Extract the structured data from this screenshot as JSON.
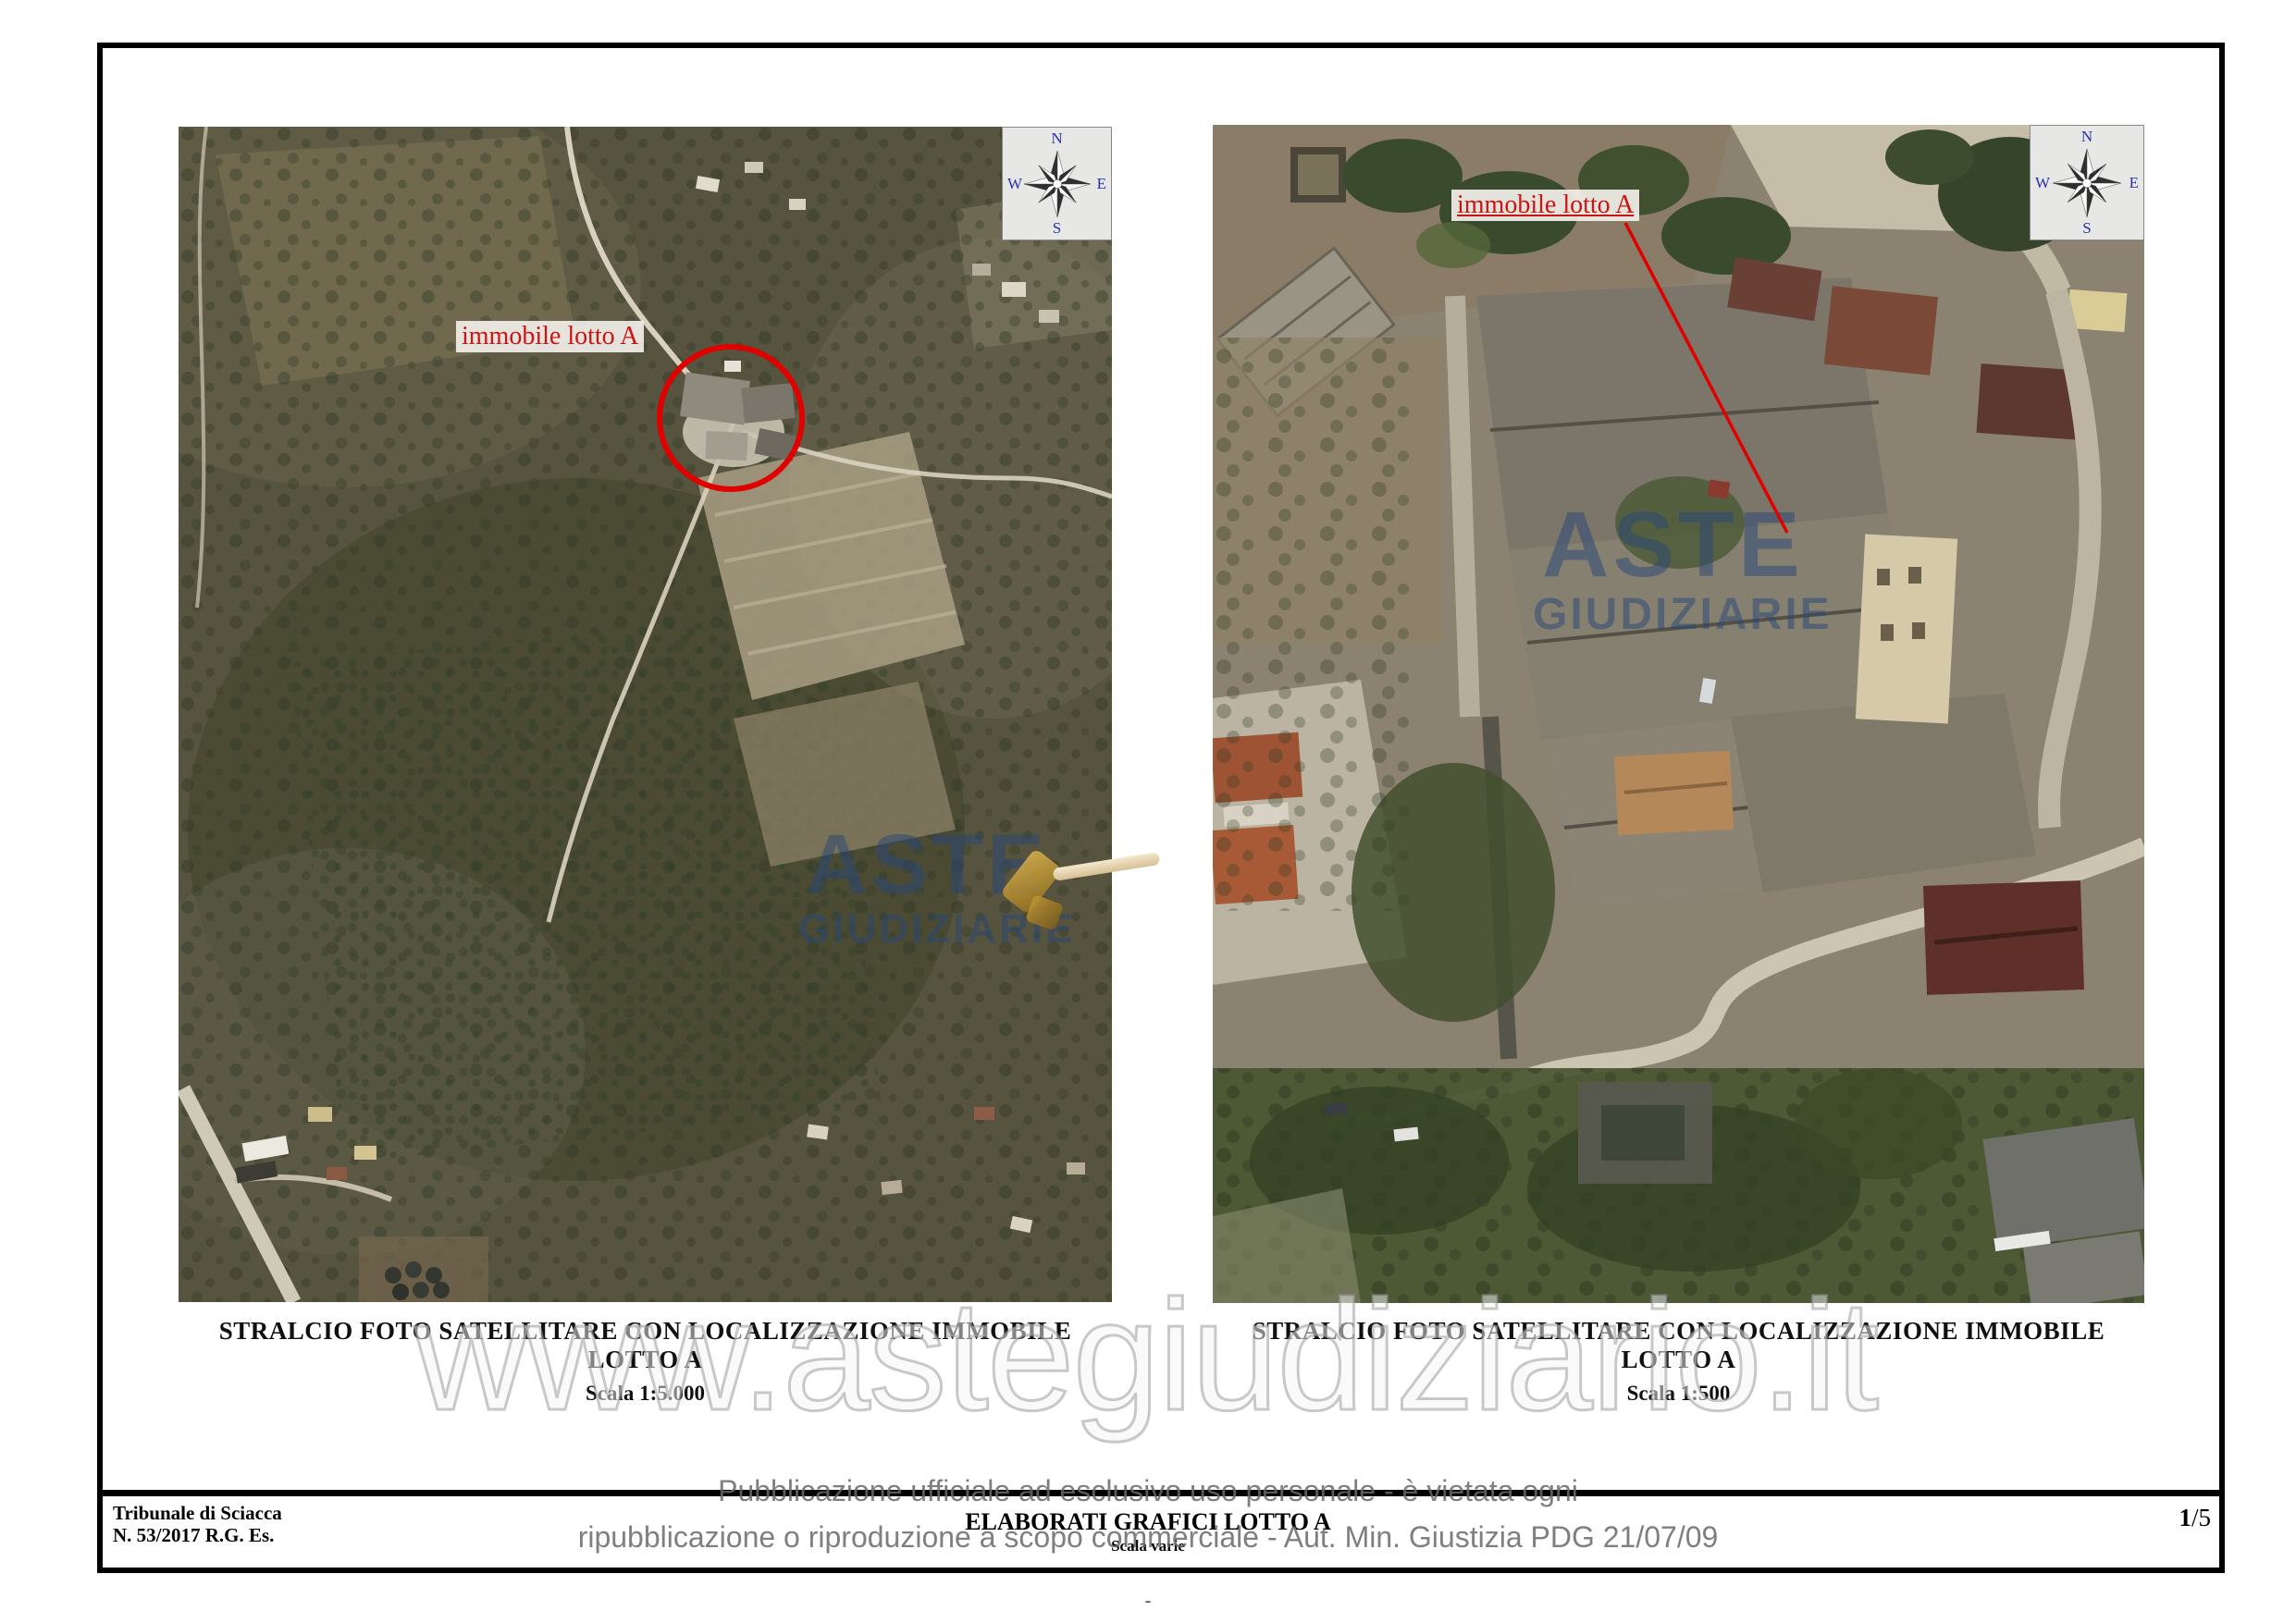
{
  "page": {
    "watermark": "www.astegiudiziario.it",
    "footnote": "-"
  },
  "disclaimer": {
    "line1": "Pubblicazione ufficiale ad esclusivo uso personale - è vietata ogni",
    "line2": "ripubblicazione o riproduzione a scopo commerciale - Aut. Min. Giustizia PDG 21/07/09"
  },
  "footer": {
    "court_name": "Tribunale di Sciacca",
    "case_number": "N. 53/2017 R.G. Es.",
    "doc_title": "ELABORATI GRAFICI LOTTO A",
    "doc_scale": "Scala varie",
    "page_current": "1",
    "page_total": "/5"
  },
  "panels": [
    {
      "caption": "STRALCIO FOTO SATELLITARE CON LOCALIZZAZIONE IMMOBILE LOTTO A",
      "scale": "Scala 1:5.000",
      "annotation": "immobile lotto A",
      "photo_watermark_line1": "ASTE",
      "photo_watermark_line2": "GIUDIZIARIE",
      "compass": {
        "n": "N",
        "e": "E",
        "s": "S",
        "w": "W"
      }
    },
    {
      "caption": "STRALCIO FOTO SATELLITARE CON LOCALIZZAZIONE IMMOBILE LOTTO A",
      "scale": "Scala 1:500",
      "annotation": "immobile lotto A",
      "photo_watermark_line1": "ASTE",
      "photo_watermark_line2": "GIUDIZIARIE",
      "compass": {
        "n": "N",
        "e": "E",
        "s": "S",
        "w": "W"
      }
    }
  ],
  "colors": {
    "annotation_red": "#e00000",
    "compass_letter_blue": "#2a32a8",
    "photo_watermark_blue": "#264678",
    "page_watermark_gray": "#9c9c9c",
    "disclaimer_gray": "#686868"
  }
}
